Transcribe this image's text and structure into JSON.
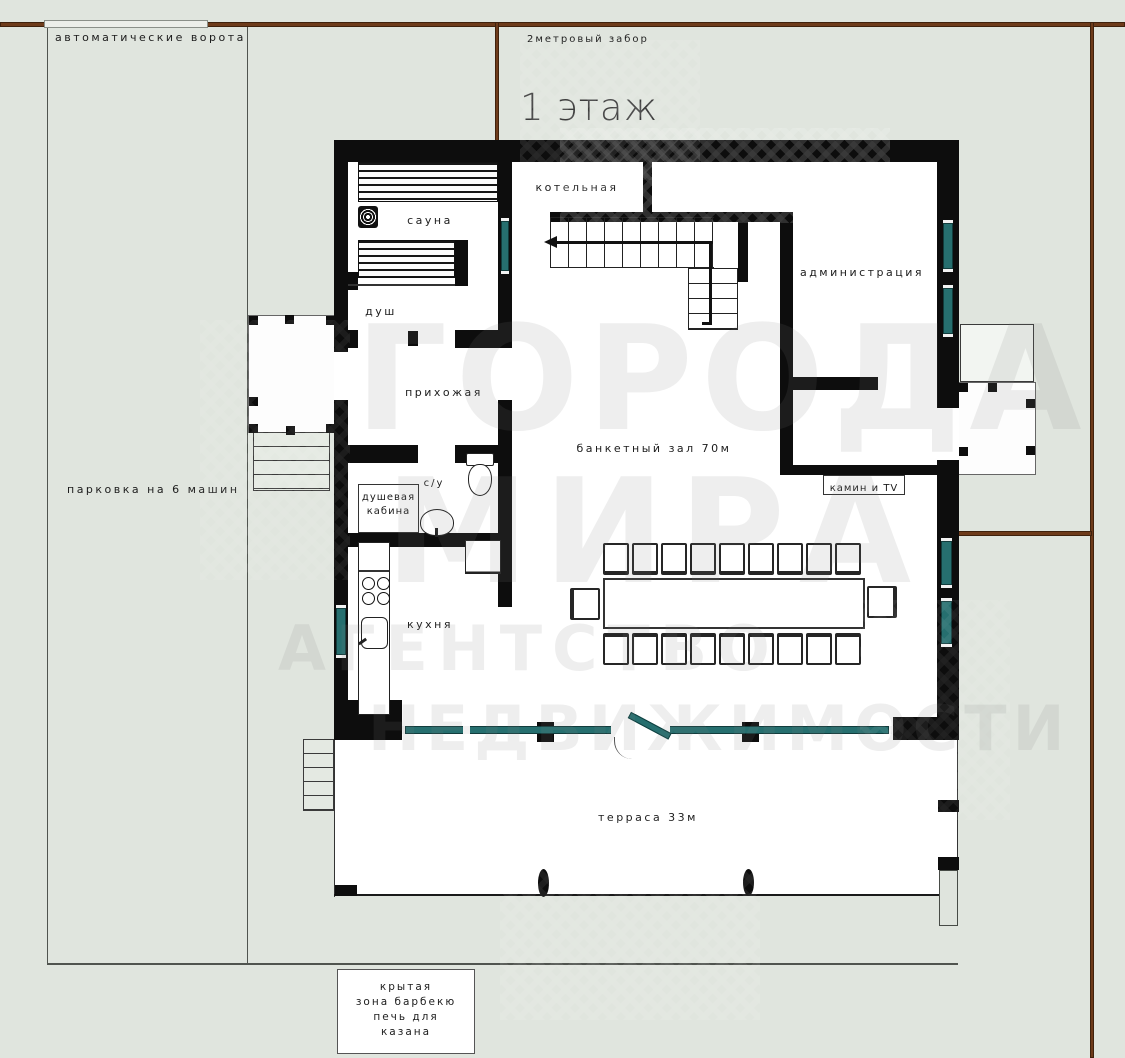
{
  "title": "1 этаж",
  "site": {
    "gate_label": "автоматические ворота",
    "fence_label": "2метровый забор",
    "parking_label": "парковка на 6 машин",
    "bbq_lines": [
      "крытая",
      "зона барбекю",
      "печь для",
      "казана"
    ]
  },
  "rooms": {
    "sauna": "сауна",
    "boiler": "котельная",
    "shower": "душ",
    "hallway": "прихожая",
    "admin": "администрация",
    "banquet": "банкетный зал 70м",
    "wc": "с/у",
    "shower_cabin_lines": [
      "душевая",
      "кабина"
    ],
    "kitchen": "кухня",
    "fireplace_tv": "камин и TV",
    "terrace": "терраса 33м"
  },
  "watermark": {
    "brand_line1": "ГОРОДА",
    "brand_line2": "МИРА",
    "brand_line3": "АГЕНТСТВО",
    "brand_line4": "НЕДВИЖИМОСТИ"
  },
  "colors": {
    "background": "#e0e5de",
    "wall": "#0d0d0d",
    "window_glass": "#266f6f",
    "fence": "#6e3b1a",
    "floor": "#ffffff"
  }
}
